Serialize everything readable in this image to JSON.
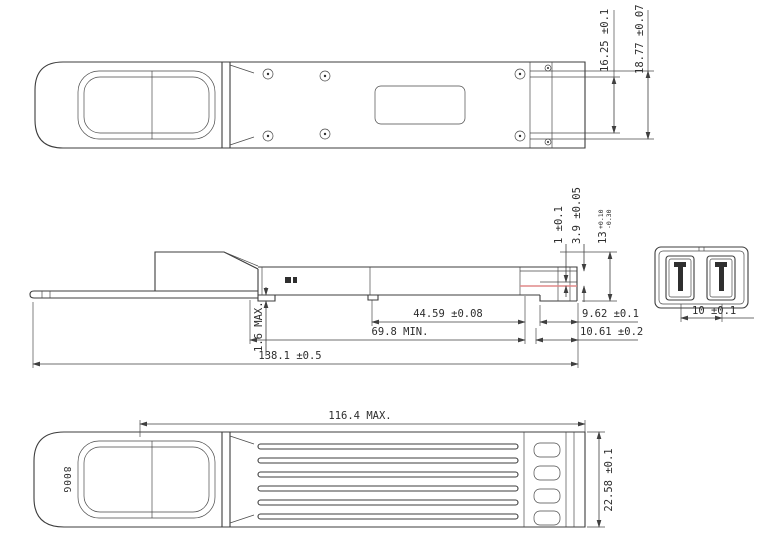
{
  "drawing": {
    "type": "mechanical-dimension-drawing",
    "subject": "800G optical transceiver module, three-view outline drawing",
    "colors": {
      "line": "#3c3c3c",
      "background": "#ffffff",
      "highlight": "#e08888"
    },
    "views": {
      "top": {
        "dims": {
          "rail_width": "16.25 ±0.1",
          "body_width": "18.77 ±0.07"
        }
      },
      "side": {
        "dims": {
          "step": "1 ±0.1",
          "nose": "3.9 ±0.05",
          "height_nominal": "13",
          "height_tol_plus": "+0.10",
          "height_tol_minus": "-0.30",
          "latch_to_front": "44.59 ±0.08",
          "body_min": "69.8 MIN.",
          "overall_length": "138.1 ±0.5",
          "tab_thickness": "1.6 MAX.",
          "front_a": "9.62 ±0.1",
          "front_b": "10.61 ±0.2"
        }
      },
      "end": {
        "dims": {
          "port_pitch": "10 ±0.1"
        }
      },
      "bottom": {
        "label": "800G",
        "dims": {
          "finned_length": "116.4 MAX.",
          "body_width": "22.58 ±0.1"
        }
      }
    }
  }
}
